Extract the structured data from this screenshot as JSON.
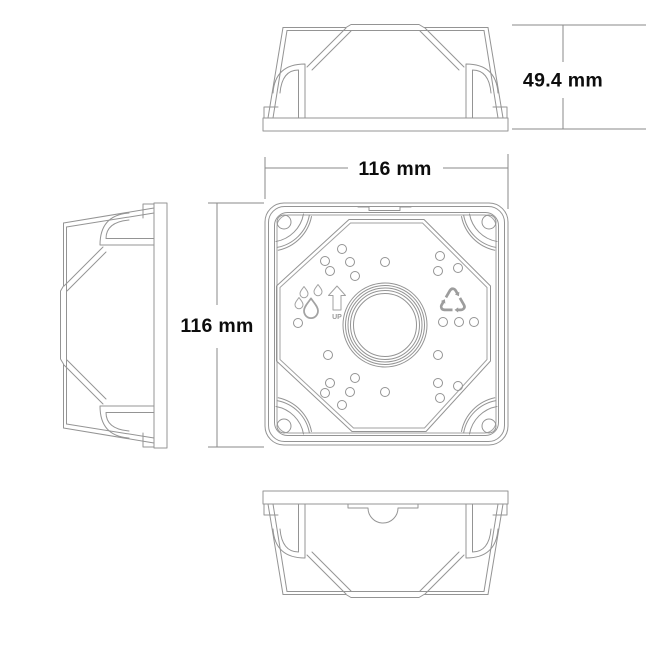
{
  "dimensions": {
    "height_label": "49.4 mm",
    "width_label": "116 mm",
    "depth_label": "116 mm"
  },
  "front": {
    "up_label": "UP"
  },
  "icons": {
    "water_drops": "water-drops-icon",
    "up_arrow": "up-arrow-icon",
    "recycle": "recycle-icon",
    "recycle_glyph": "♺"
  },
  "colors": {
    "background": "#ffffff",
    "drawing_line": "#949494",
    "dimension_line": "#8a8a8a",
    "dimension_text": "#0d0d0d",
    "icon_line": "#9a9a9a"
  }
}
